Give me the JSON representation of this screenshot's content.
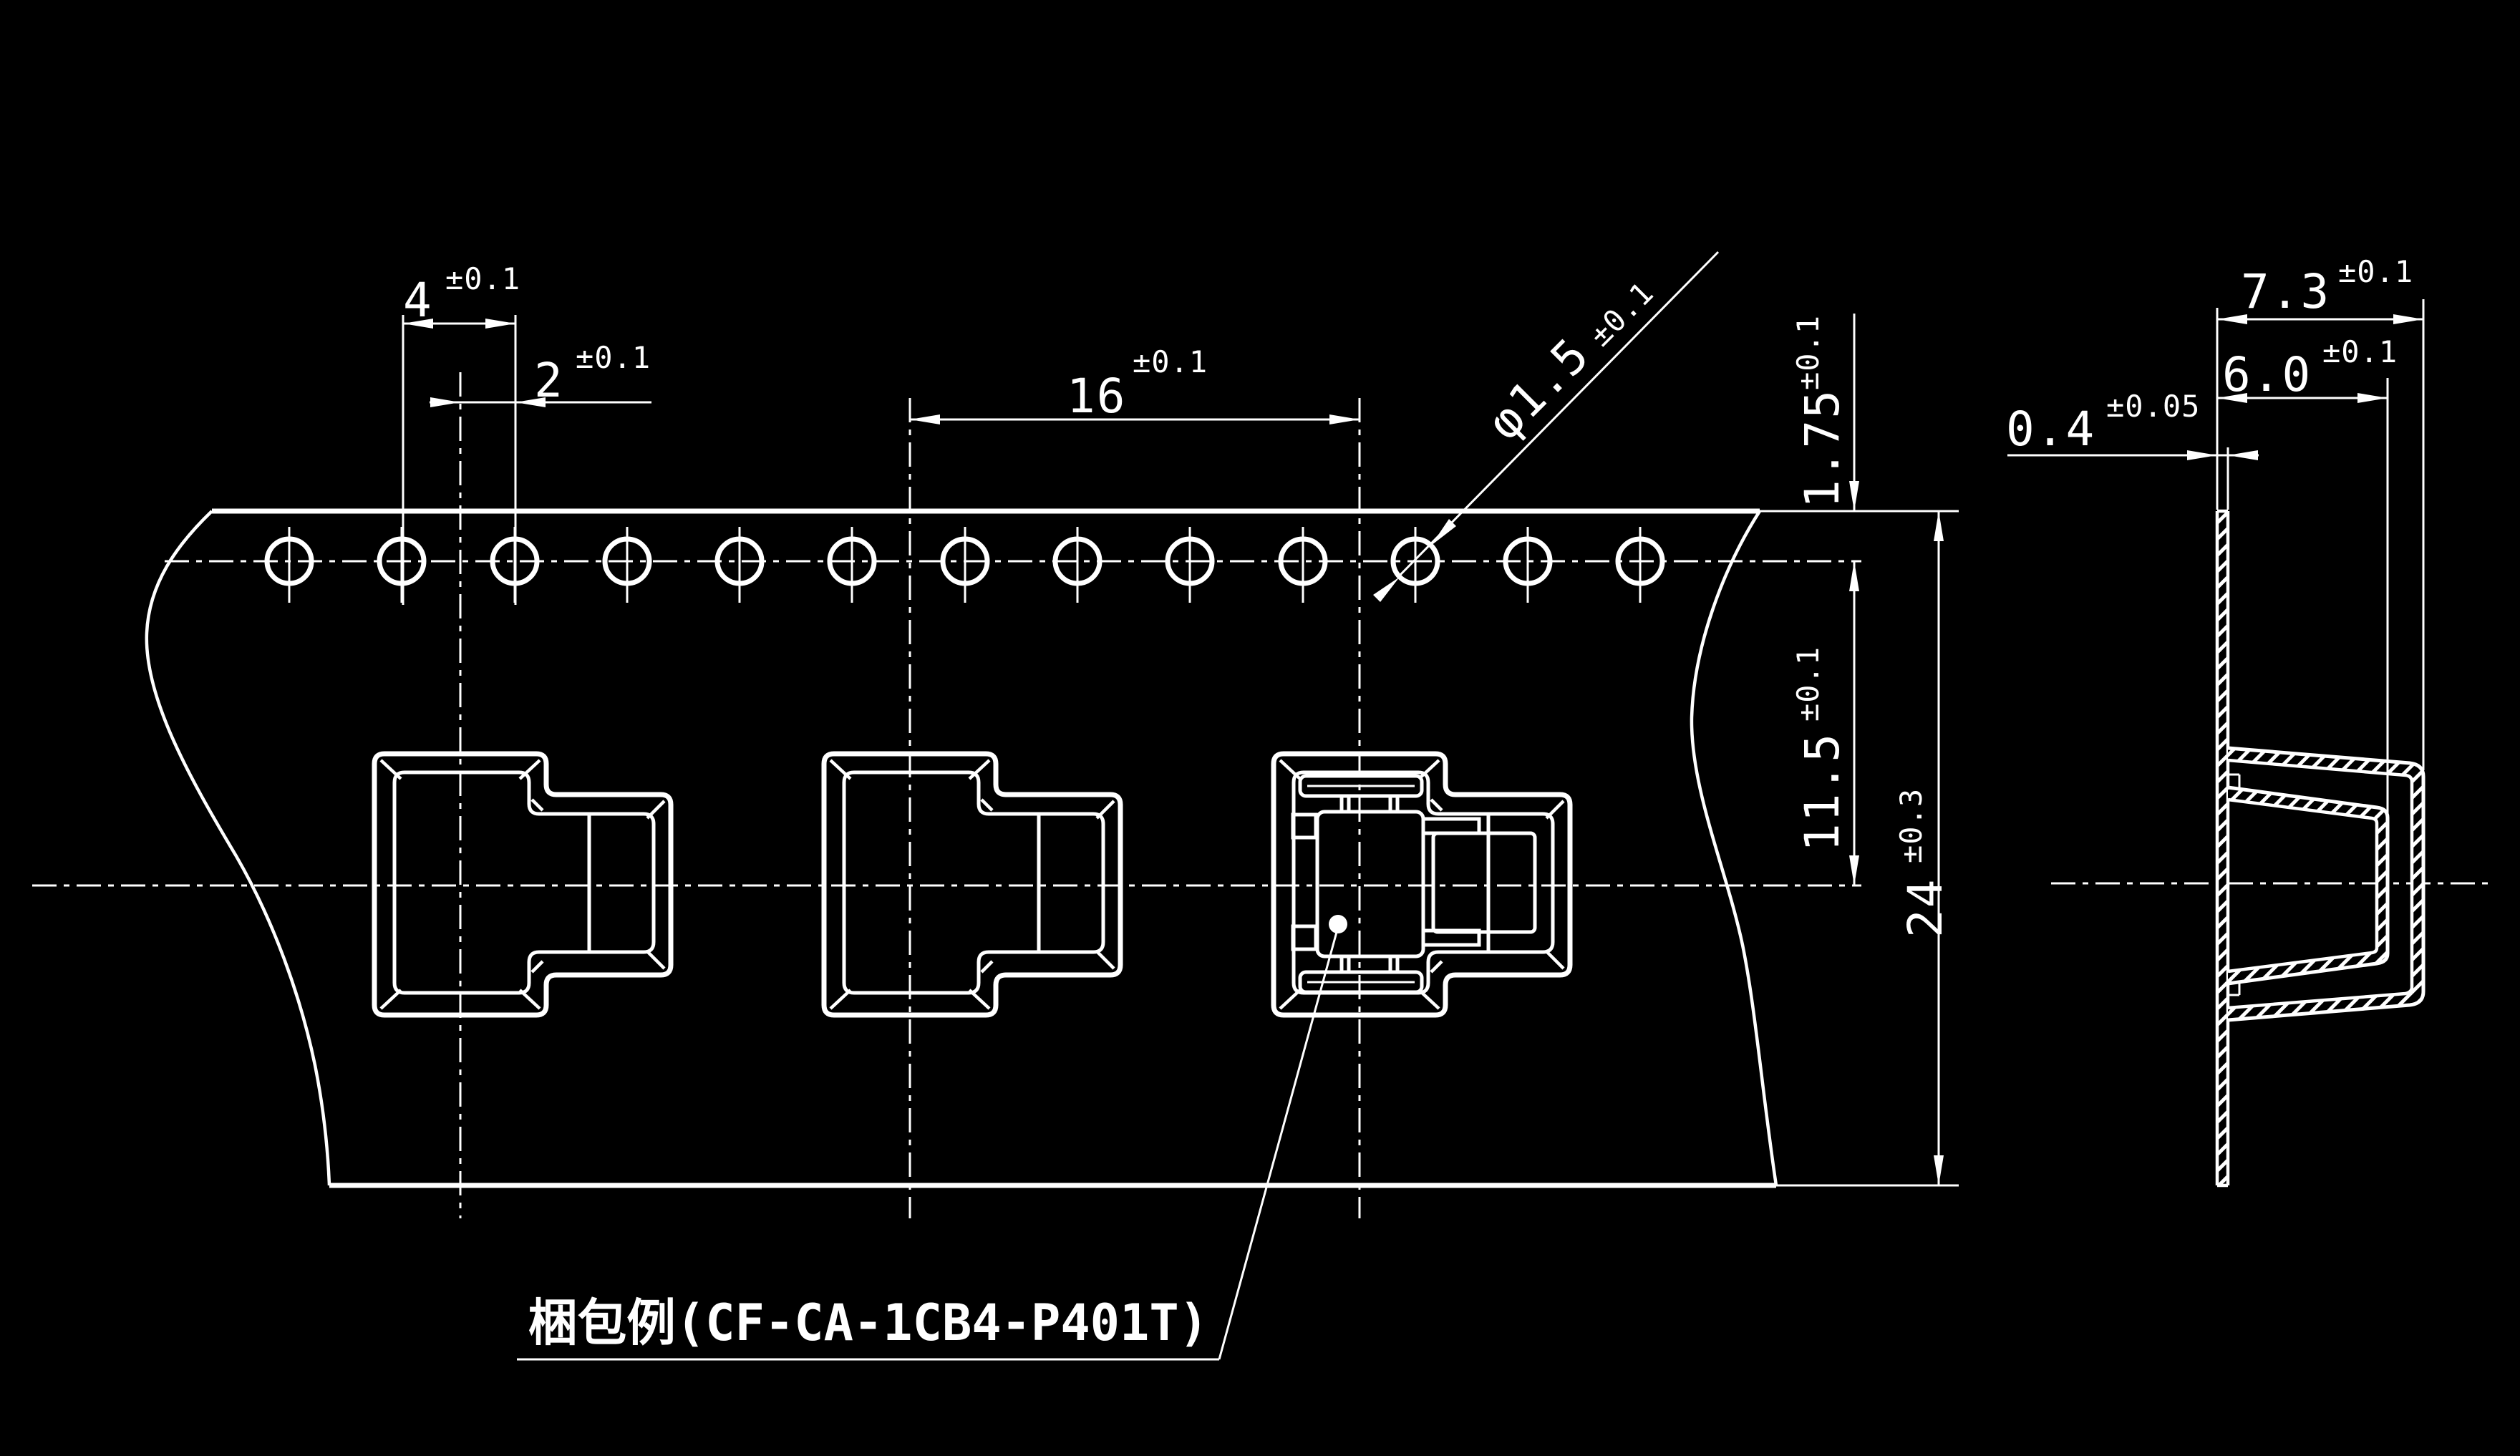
{
  "drawing": {
    "background_color": "#000000",
    "line_color": "#ffffff",
    "packaging_example_label": "梱包例(CF-CA-1CB4-P401T)",
    "part_number": "CF-CA-1CB4-P401T",
    "sprocket_hole_count": 13,
    "pocket_count": 3,
    "dimensions": {
      "hole_pitch": {
        "value": "4",
        "tolerance": "±0.1"
      },
      "hole_to_pocket_offset": {
        "value": "2",
        "tolerance": "±0.1"
      },
      "pocket_pitch": {
        "value": "16",
        "tolerance": "±0.1"
      },
      "sprocket_hole_diameter": {
        "value": "φ1.5",
        "tolerance": "±0.1"
      },
      "edge_to_hole_center": {
        "value": "1.75",
        "tolerance": "±0.1"
      },
      "hole_to_pocket_center": {
        "value": "11.5",
        "tolerance": "±0.1"
      },
      "tape_width": {
        "value": "24",
        "tolerance": "±0.3"
      },
      "emboss_depth_outer": {
        "value": "7.3",
        "tolerance": "±0.1"
      },
      "emboss_depth_inner": {
        "value": "6.0",
        "tolerance": "±0.1"
      },
      "tape_thickness": {
        "value": "0.4",
        "tolerance": "±0.05"
      }
    }
  }
}
